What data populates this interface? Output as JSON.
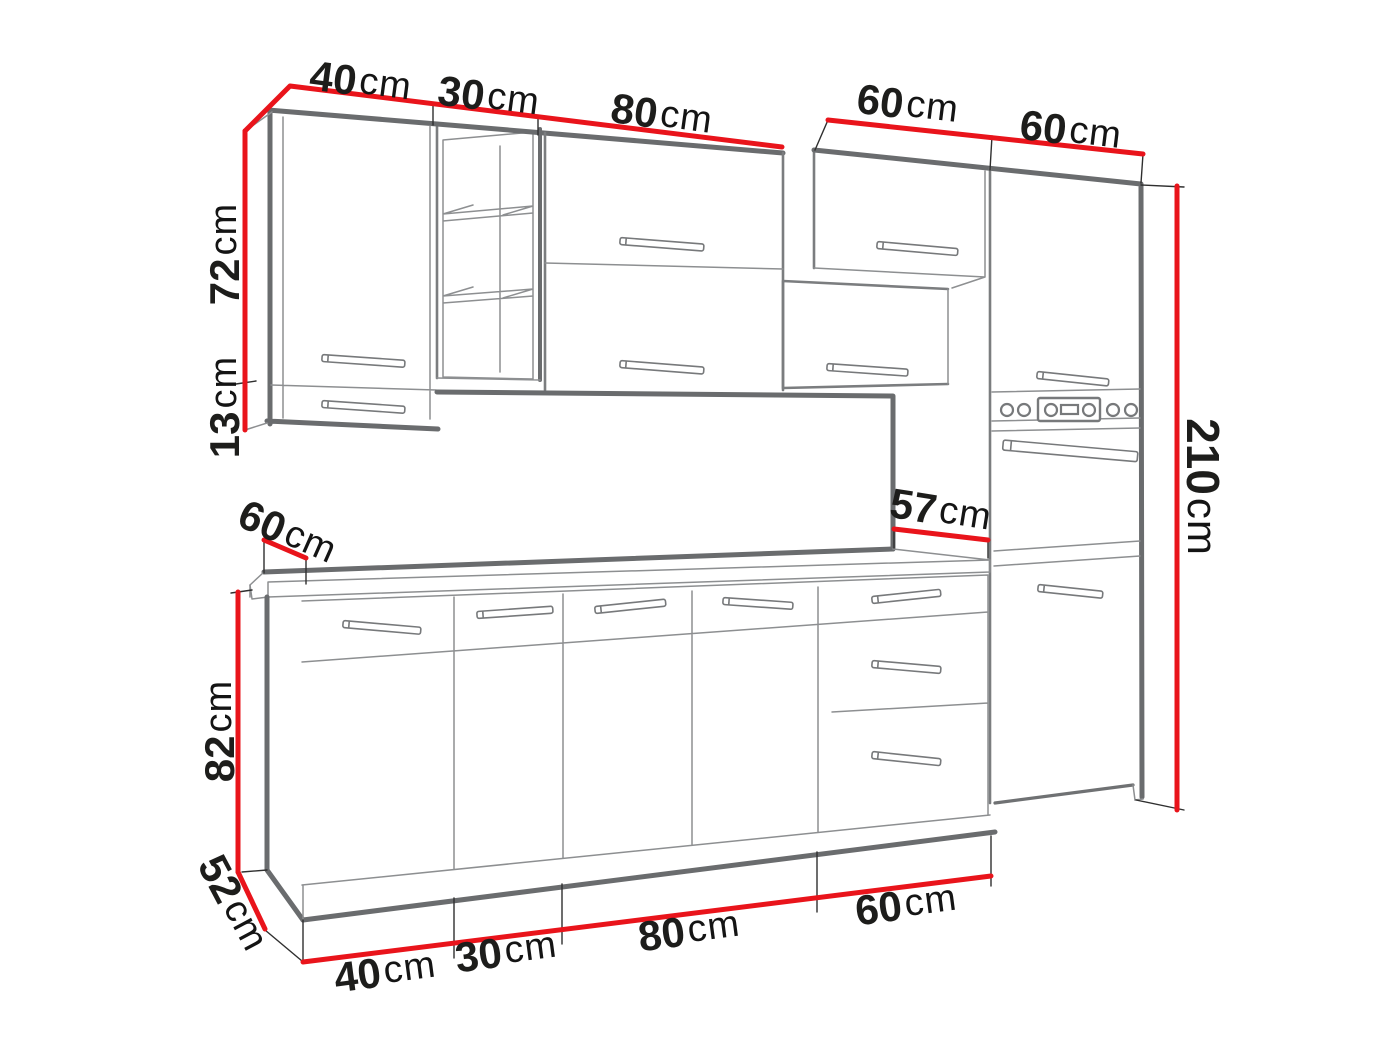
{
  "drawing": {
    "name": "kitchen-set-dimension-diagram",
    "palette": {
      "dimension_red": "#e9141b",
      "outline_dark": "#6a6c6e",
      "outline_light": "#8d8f91",
      "label_text": "#1d1d1b",
      "background": "#ffffff"
    }
  },
  "dims": {
    "top_40": {
      "value": "40",
      "unit": "cm"
    },
    "top_30": {
      "value": "30",
      "unit": "cm"
    },
    "top_80": {
      "value": "80",
      "unit": "cm"
    },
    "top_60_hood": {
      "value": "60",
      "unit": "cm"
    },
    "top_60_tall": {
      "value": "60",
      "unit": "cm"
    },
    "left_72": {
      "value": "72",
      "unit": "cm"
    },
    "left_13": {
      "value": "13",
      "unit": "cm"
    },
    "right_210": {
      "value": "210",
      "unit": "cm"
    },
    "counter_60": {
      "value": "60",
      "unit": "cm"
    },
    "counter_57": {
      "value": "57",
      "unit": "cm"
    },
    "base_82": {
      "value": "82",
      "unit": "cm"
    },
    "base_52": {
      "value": "52",
      "unit": "cm"
    },
    "bottom_40": {
      "value": "40",
      "unit": "cm"
    },
    "bottom_30": {
      "value": "30",
      "unit": "cm"
    },
    "bottom_80": {
      "value": "80",
      "unit": "cm"
    },
    "bottom_60": {
      "value": "60",
      "unit": "cm"
    }
  }
}
